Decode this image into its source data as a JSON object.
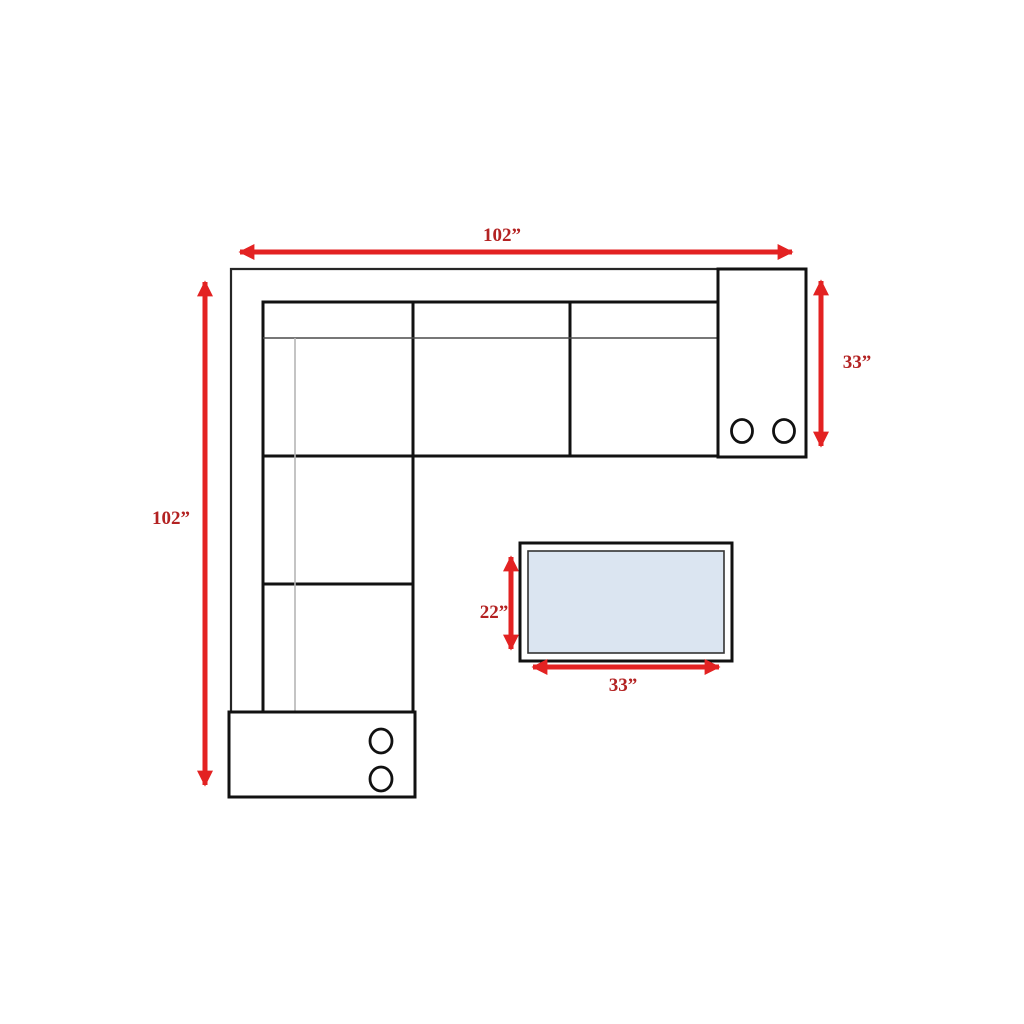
{
  "diagram": {
    "sofa": {
      "width_label": "102”",
      "depth_label": "102”",
      "right_section_depth_label": "33”"
    },
    "coffee_table": {
      "depth_label": "22”",
      "width_label": "33”"
    },
    "colors": {
      "arrow_red": "#e32222",
      "label_red": "#b32222",
      "sofa_outline_black": "#111111",
      "table_top_fill": "#dbe5f1",
      "background": "#ffffff"
    }
  }
}
